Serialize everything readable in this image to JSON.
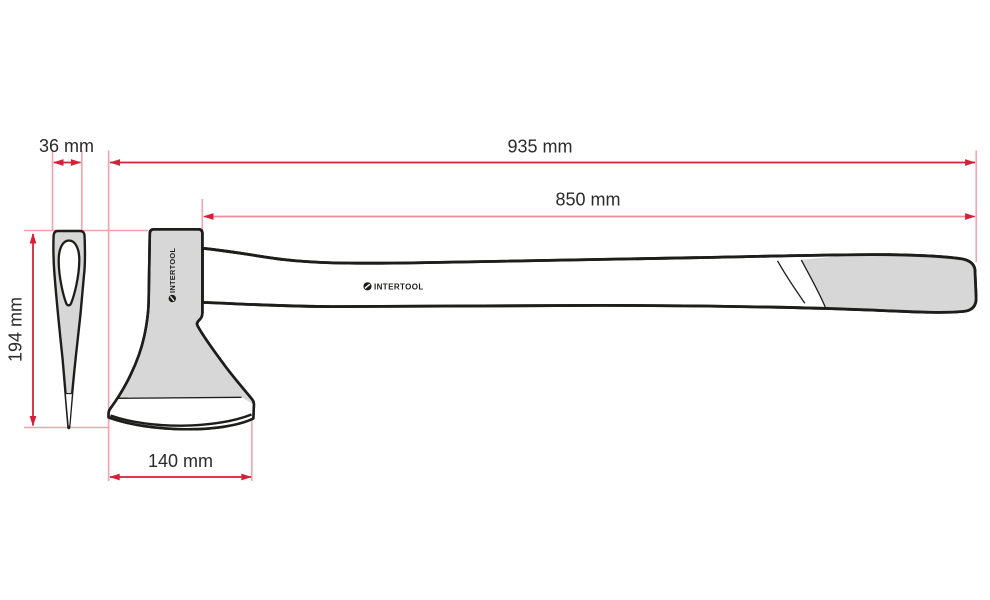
{
  "page": {
    "description": "Technical dimension drawing of an axe (side view and front view) with red dimension lines"
  },
  "colors": {
    "background": "#ffffff",
    "outline_black": "#1d1d1b",
    "fill_gray": "#d7d7d7",
    "dimension_red": "#d6203a",
    "dimension_light_red": "#f4a3ad",
    "label_text": "#2b2a2a"
  },
  "dimension_labels": {
    "total_length": "935 mm",
    "handle_length": "850 mm",
    "eye_width": "36 mm",
    "head_height": "194 mm",
    "blade_width": "140 mm"
  },
  "branding": {
    "handle_logo_text": "INTERTOOL",
    "head_logo_text": "INTERTOOL"
  }
}
